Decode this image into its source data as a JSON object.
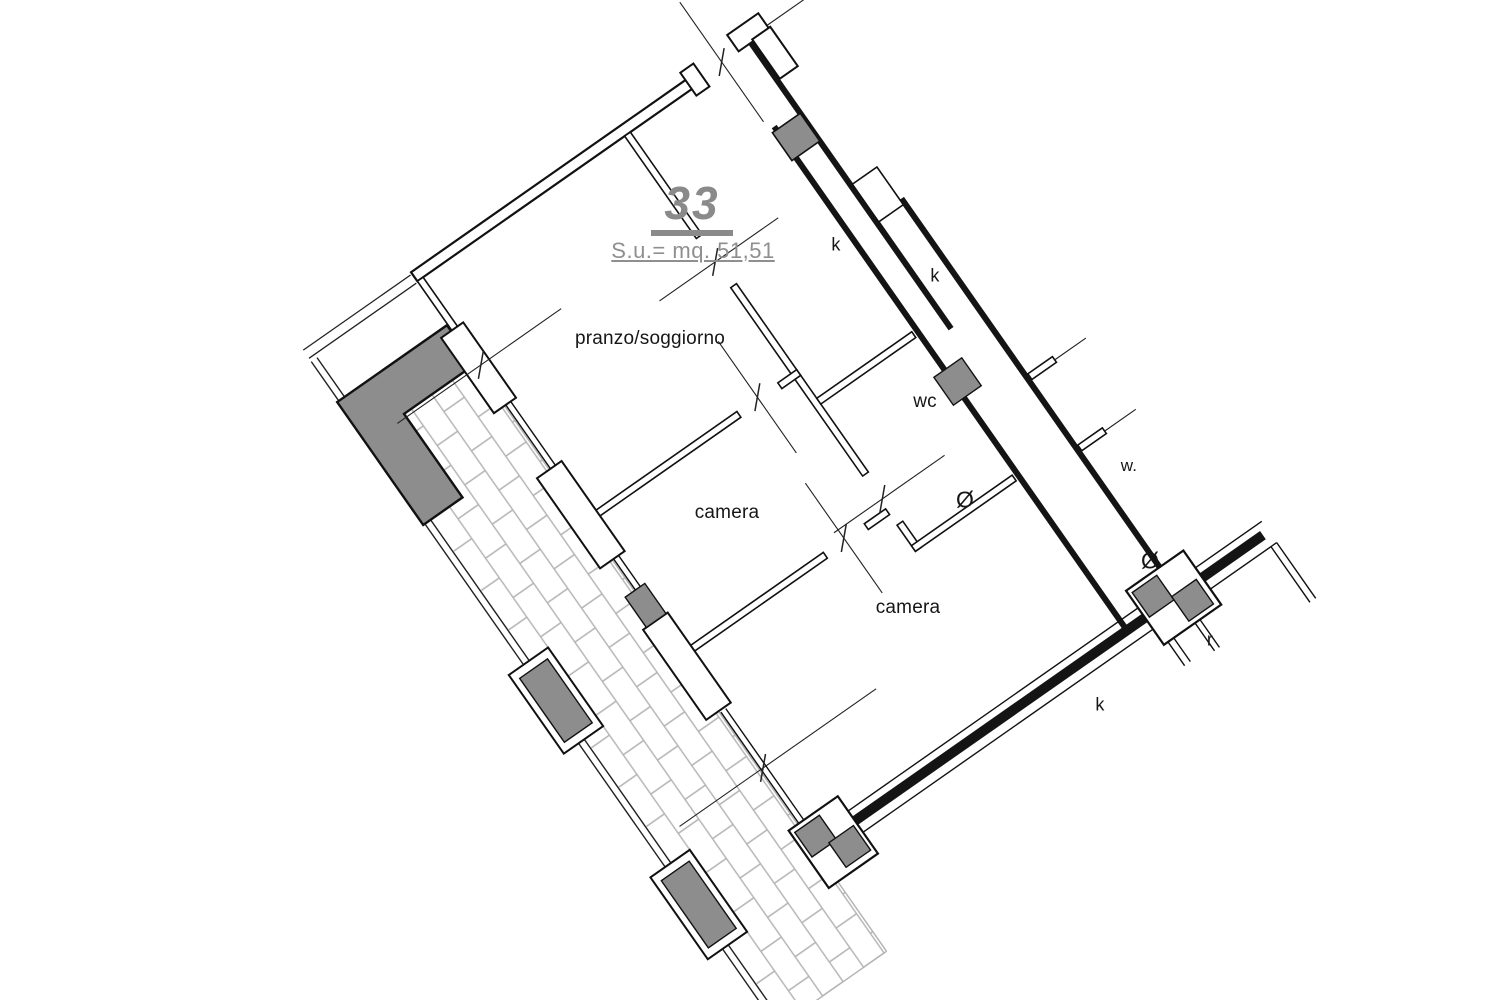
{
  "title": {
    "unit_number": "33",
    "area": "S.u.= mq. 51,51"
  },
  "rooms": {
    "living": "pranzo/soggiorno",
    "bedroom1": "camera",
    "bedroom2": "camera",
    "wc": "wc"
  },
  "annotations": {
    "k_top": "k",
    "k_mid": "k",
    "k_bottom": "k",
    "w": "w.",
    "r": "r",
    "vent_wc": "Ø",
    "vent_corridor": "Ø"
  },
  "colors": {
    "wall": "#141414",
    "pillar": "#8d8d8d",
    "hatch": "#b2b2b2",
    "muted_text": "#8f8f8f",
    "paper": "#ffffff"
  }
}
